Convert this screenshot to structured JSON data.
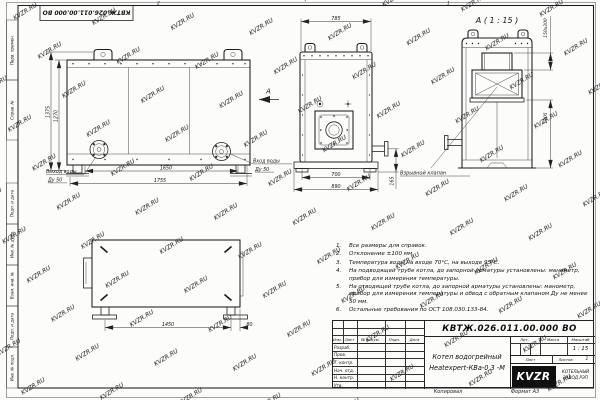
{
  "watermark": {
    "text": "KVZR.RU"
  },
  "frame": {
    "top_stamp": "КВТЖ.026.011.00.000 ВО",
    "zone_digit_left": "2",
    "zone_digit_right": "1",
    "left_margin_top": [
      {
        "label": "Перв. примен."
      },
      {
        "label": "Справ. №"
      }
    ],
    "left_margin_bottom": [
      {
        "label": "Подп. и дата"
      },
      {
        "label": "Инв. № дубл."
      },
      {
        "label": "Взам. инв. №"
      },
      {
        "label": "Подп. и дата"
      },
      {
        "label": "Инв. № подл."
      }
    ]
  },
  "views": {
    "front": {
      "dim_height_total": "1375",
      "dim_height_body": "1270",
      "dim_width_body": "1650",
      "dim_width_total": "1755",
      "outlet_label_1": "Выход воды",
      "outlet_label_2": "Ду 50",
      "inlet_label_1": "Вход воды",
      "inlet_label_2": "Ду 50",
      "view_arrow_label": "А"
    },
    "side": {
      "dim_width_top": "785",
      "dim_width_base": "700",
      "dim_width_total": "890",
      "dim_stub_height": "165"
    },
    "detail": {
      "title": "А ( 1 : 15 )",
      "dim_valve": "150х300",
      "dim_height": "1005",
      "callout": "Взрывной клапан"
    },
    "top": {
      "dim_length": "1450",
      "dim_offset": "80"
    }
  },
  "notes": {
    "items": [
      {
        "num": "1.",
        "text": "Все размеры для справок."
      },
      {
        "num": "2.",
        "text": "Отклонение ±100 мм."
      },
      {
        "num": "3.",
        "text": "Температура воды на входе 70°С, на выходе 95°С."
      },
      {
        "num": "4.",
        "text": "На подводящей трубе котла, до запорной арматуры установлены: манометр, прибор для измерения температуры."
      },
      {
        "num": "5.",
        "text": "На отводящей трубе котла, до запорной арматуры установлены: манометр, прибор для измерения температуры и обвод с обратным клапаном Ду не менее 50 мм."
      },
      {
        "num": "6.",
        "text": "Остальные требования по ОСТ 108.030.133-84."
      }
    ]
  },
  "titleblock": {
    "doc_number": "КВТЖ.026.011.00.000 ВО",
    "product_name_1": "Котел водогрейный",
    "product_name_2": "Heatexpert-КВа-0,3 -М",
    "col_izm": "Изм.",
    "col_list": "Лист",
    "col_doc": "№ докум.",
    "col_podp": "Подп.",
    "col_data": "Дата",
    "row_labels": [
      {
        "label": "Разраб."
      },
      {
        "label": "Пров."
      },
      {
        "label": "Т. контр."
      },
      {
        "label": "Нач. отд."
      },
      {
        "label": "Н. контр."
      },
      {
        "label": "Утв."
      }
    ],
    "lit_label": "Лит.",
    "mass_label": "Масса",
    "scale_label": "Масштаб",
    "scale_value": "1 : 15",
    "sheet_label": "Лист",
    "sheets_label": "Листов",
    "sheets_value": "1",
    "logo_text": "KVZR",
    "company_1": "КОТЕЛЬНЫЙ",
    "company_2": "ЗАВОД РЭП",
    "copied_label": "Копировал",
    "format_label": "Формат А3"
  }
}
